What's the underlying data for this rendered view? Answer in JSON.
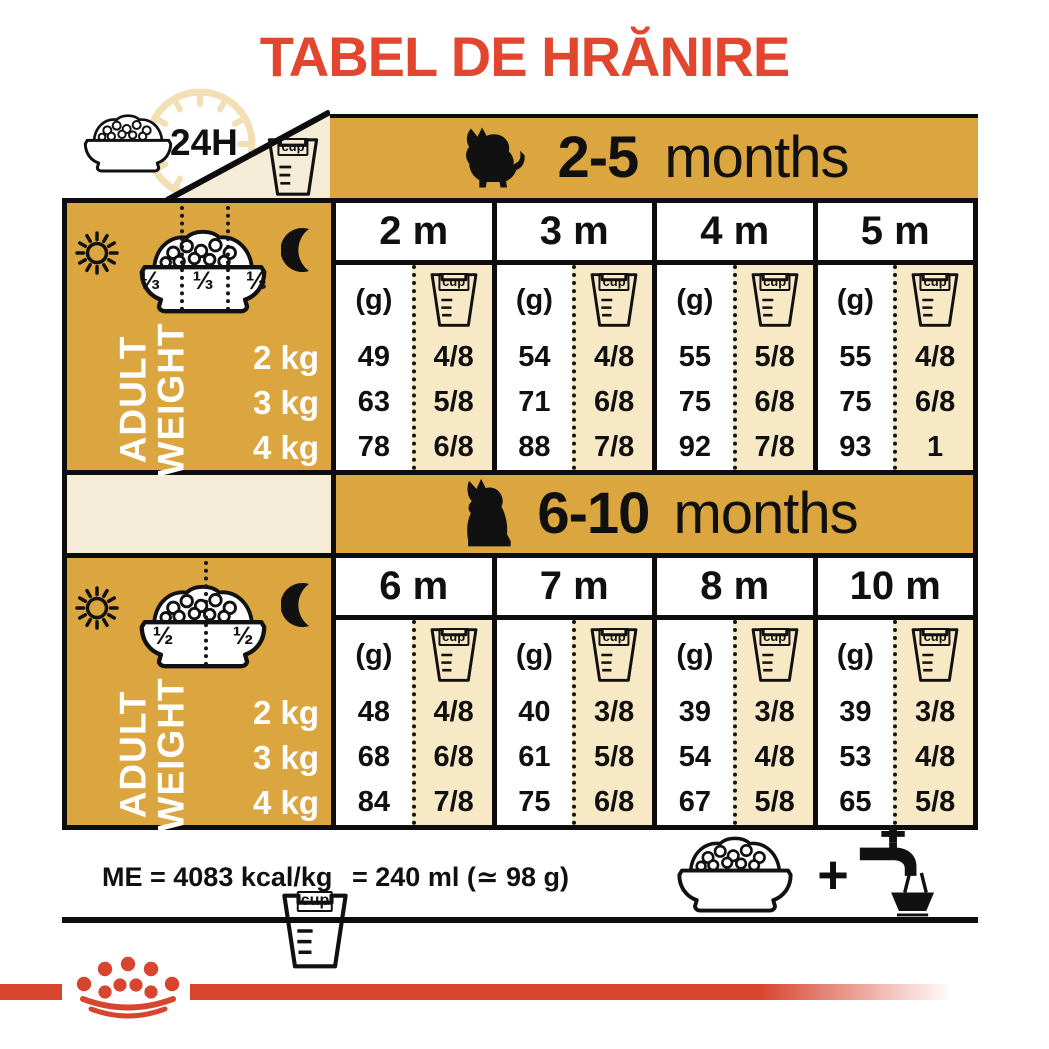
{
  "title": "TABEL DE HRĂNIRE",
  "colors": {
    "accent_red": "#E2462E",
    "stripe_red": "#D8452F",
    "gold": "#DBA63F",
    "cup_column_cream": "#F7E9C5",
    "band_cream": "#F5ECD7"
  },
  "header": {
    "hours": "24H",
    "cup": "cup"
  },
  "row_labels": {
    "adult_weight": [
      "ADULT",
      "WEIGHT"
    ],
    "weights": [
      "2 kg",
      "3 kg",
      "4 kg"
    ],
    "grams": "(g)"
  },
  "sections": [
    {
      "range": "2-5",
      "unit": "months",
      "fractions": [
        "⅓",
        "⅓",
        "⅓"
      ],
      "columns": [
        {
          "month": "2 m",
          "g": [
            "49",
            "63",
            "78"
          ],
          "cups": [
            "4/8",
            "5/8",
            "6/8"
          ]
        },
        {
          "month": "3 m",
          "g": [
            "54",
            "71",
            "88"
          ],
          "cups": [
            "4/8",
            "6/8",
            "7/8"
          ]
        },
        {
          "month": "4 m",
          "g": [
            "55",
            "75",
            "92"
          ],
          "cups": [
            "5/8",
            "6/8",
            "7/8"
          ]
        },
        {
          "month": "5 m",
          "g": [
            "55",
            "75",
            "93"
          ],
          "cups": [
            "4/8",
            "6/8",
            "1"
          ]
        }
      ]
    },
    {
      "range": "6-10",
      "unit": "months",
      "fractions": [
        "½",
        "½"
      ],
      "columns": [
        {
          "month": "6 m",
          "g": [
            "48",
            "68",
            "84"
          ],
          "cups": [
            "4/8",
            "6/8",
            "7/8"
          ]
        },
        {
          "month": "7 m",
          "g": [
            "40",
            "61",
            "75"
          ],
          "cups": [
            "3/8",
            "5/8",
            "6/8"
          ]
        },
        {
          "month": "8 m",
          "g": [
            "39",
            "54",
            "67"
          ],
          "cups": [
            "3/8",
            "4/8",
            "5/8"
          ]
        },
        {
          "month": "10 m",
          "g": [
            "39",
            "53",
            "65"
          ],
          "cups": [
            "3/8",
            "4/8",
            "5/8"
          ]
        }
      ]
    }
  ],
  "footer": {
    "me": "ME = 4083 kcal/kg",
    "cup_equiv": "= 240 ml (≃ 98 g)",
    "plus": "+"
  }
}
